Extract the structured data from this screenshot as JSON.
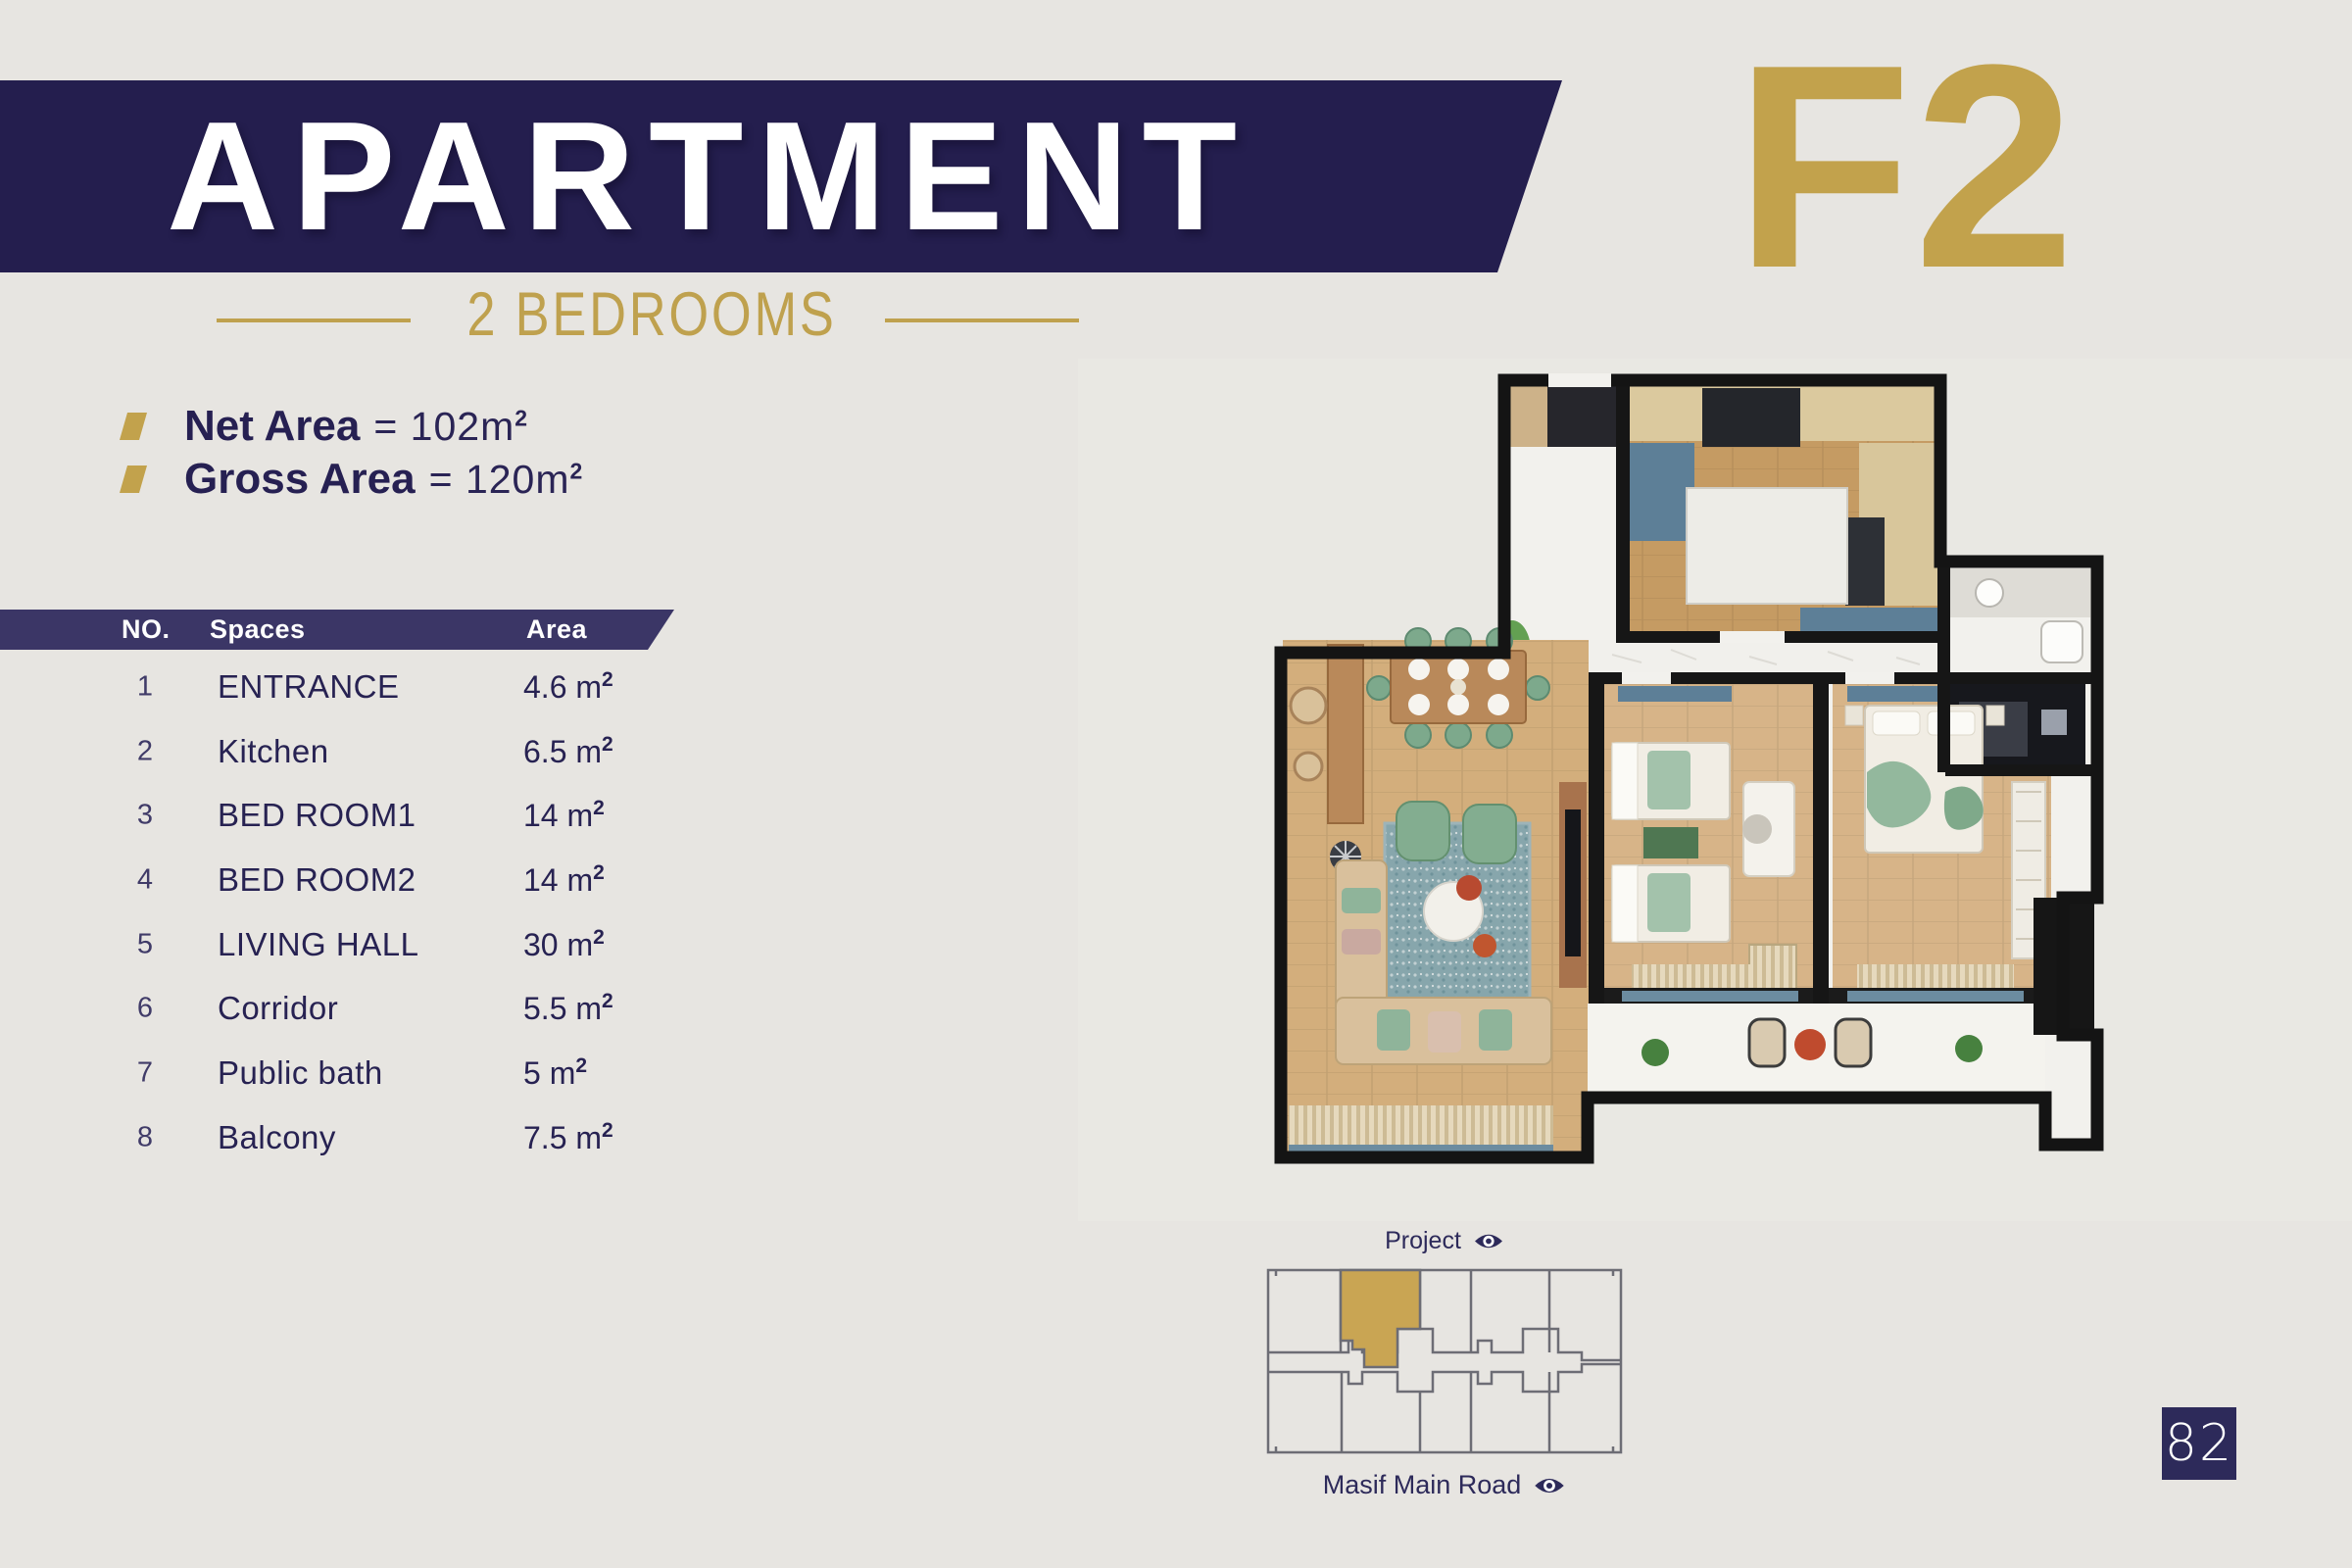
{
  "palette": {
    "page_bg": "#e7e5e1",
    "banner_navy": "#241e4e",
    "table_header_navy": "#3b3666",
    "text_navy": "#272252",
    "accent_gold": "#c2a24c",
    "site_outline_gray": "#6d6d75",
    "site_unit_gold": "#c9a553"
  },
  "header": {
    "title": "APARTMENT",
    "unit_code": "F2",
    "subtitle": "2 BEDROOMS"
  },
  "areas": {
    "net_label": "Net Area",
    "net_value": "= 102m",
    "net_sup": "2",
    "gross_label": "Gross Area",
    "gross_value": "= 120m",
    "gross_sup": "2"
  },
  "table": {
    "headers": {
      "no": "NO.",
      "spaces": "Spaces",
      "area": "Area"
    },
    "rows": [
      {
        "no": "1",
        "space": "ENTRANCE",
        "area": "4.6 m",
        "sup": "2"
      },
      {
        "no": "2",
        "space": "Kitchen",
        "area": "6.5 m",
        "sup": "2"
      },
      {
        "no": "3",
        "space": "BED ROOM1",
        "area": "14 m",
        "sup": "2"
      },
      {
        "no": "4",
        "space": "BED ROOM2",
        "area": "14 m",
        "sup": "2"
      },
      {
        "no": "5",
        "space": "LIVING HALL",
        "area": "30 m",
        "sup": "2"
      },
      {
        "no": "6",
        "space": "Corridor",
        "area": "5.5 m",
        "sup": "2"
      },
      {
        "no": "7",
        "space": "Public bath",
        "area": "5 m",
        "sup": "2"
      },
      {
        "no": "8",
        "space": "Balcony",
        "area": "7.5 m",
        "sup": "2"
      }
    ]
  },
  "site_plan": {
    "project_label": "Project",
    "road_label": "Masif Main Road"
  },
  "page": {
    "number": "82"
  }
}
